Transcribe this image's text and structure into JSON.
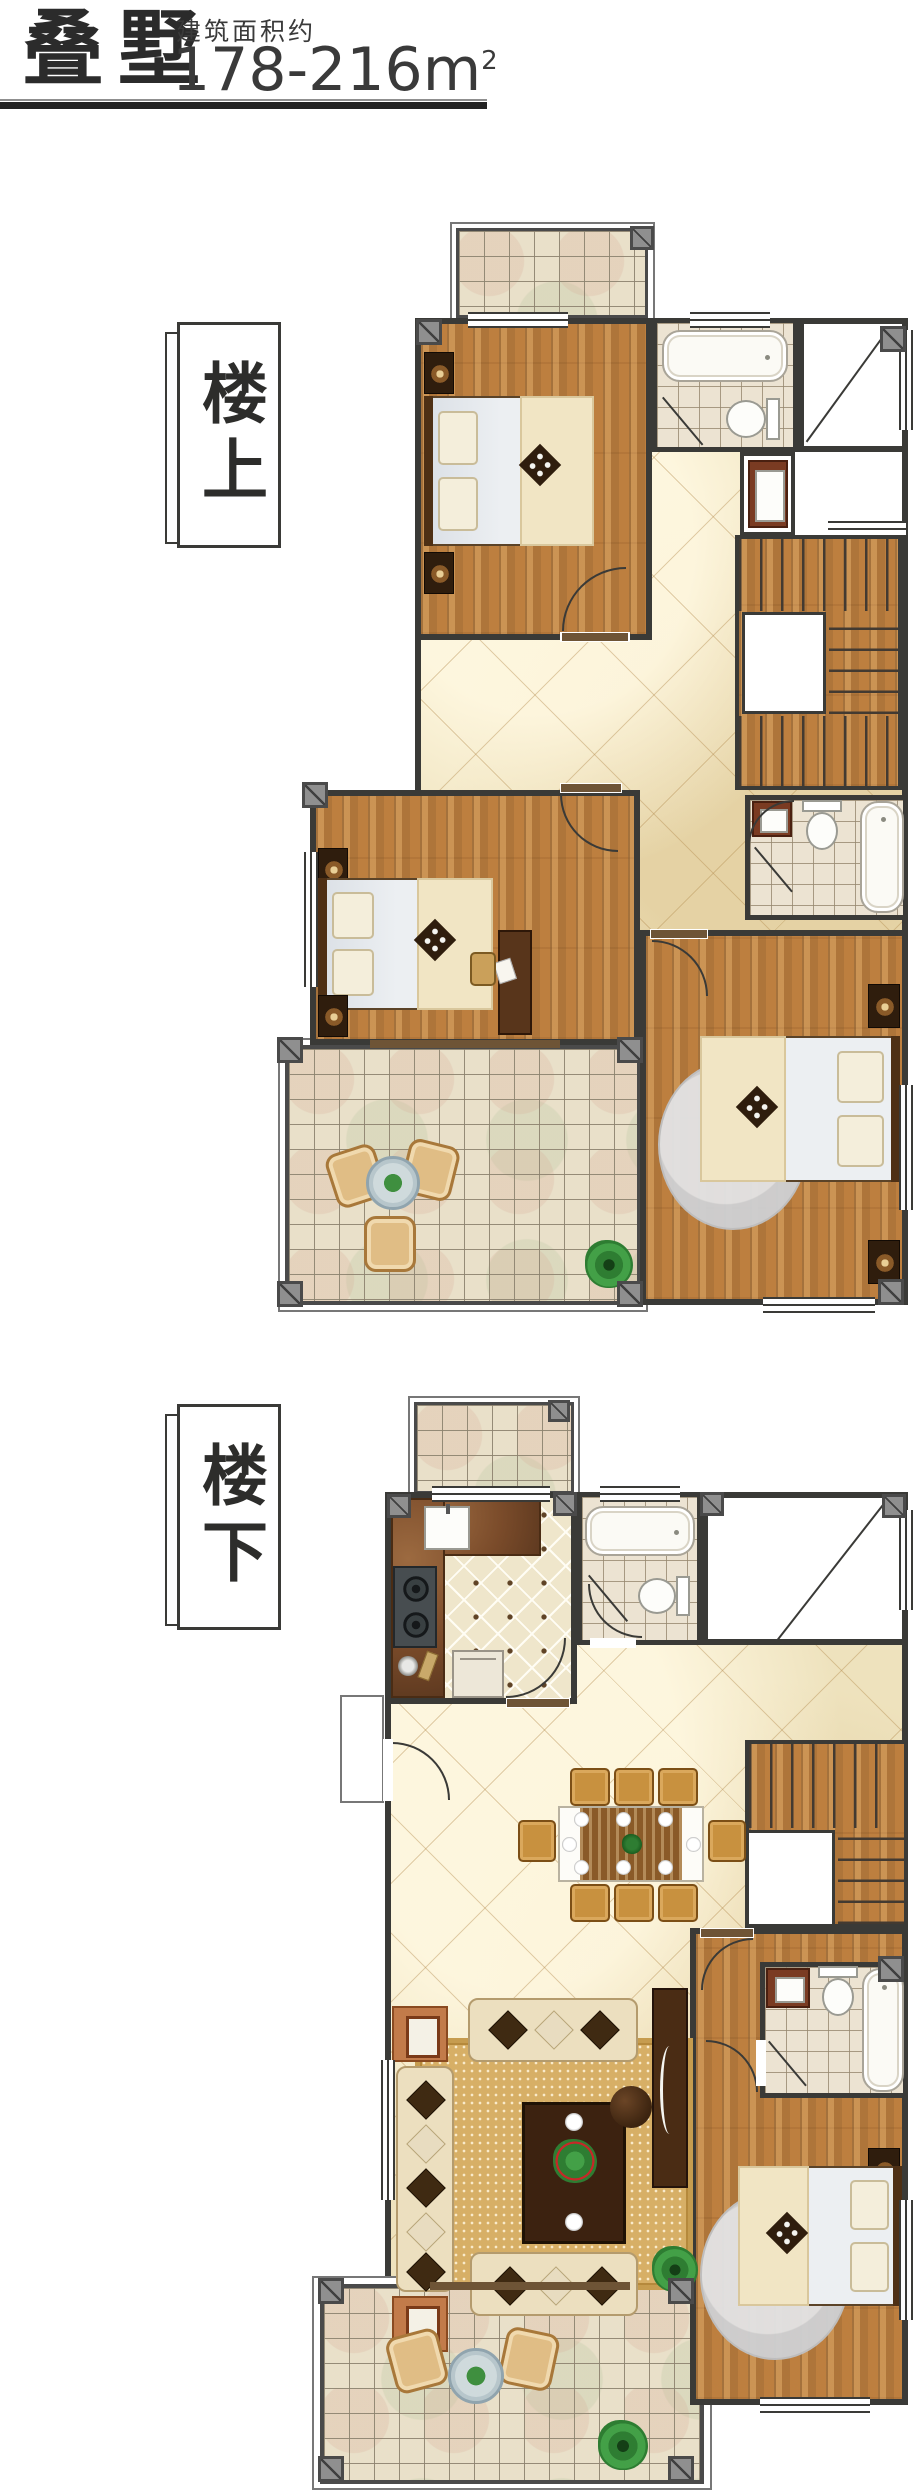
{
  "header": {
    "title": "叠墅",
    "area_label": "建筑面积约",
    "area_value": "178-216m",
    "area_sup": "2"
  },
  "floors": {
    "upper": {
      "label": "楼上"
    },
    "lower": {
      "label": "楼下"
    }
  },
  "palette": {
    "wall": "#3a3a37",
    "wood_floor": "#bd7f3f",
    "marble_hall": "#eee2bd",
    "terrace_tile": "#e9e0c9",
    "bath_tile": "#ece3d2",
    "kitchen_tile": "#efe6cb",
    "counter_brown": "#7a4b2a",
    "column_gray": "#8f8f8f",
    "dark_furniture_wood": "#3c2210",
    "sofa_cream": "#ecdfbf",
    "rug_tan": "#d7af66",
    "plant_green": "#2e7d32",
    "fixture_white": "#fbfaf5"
  }
}
